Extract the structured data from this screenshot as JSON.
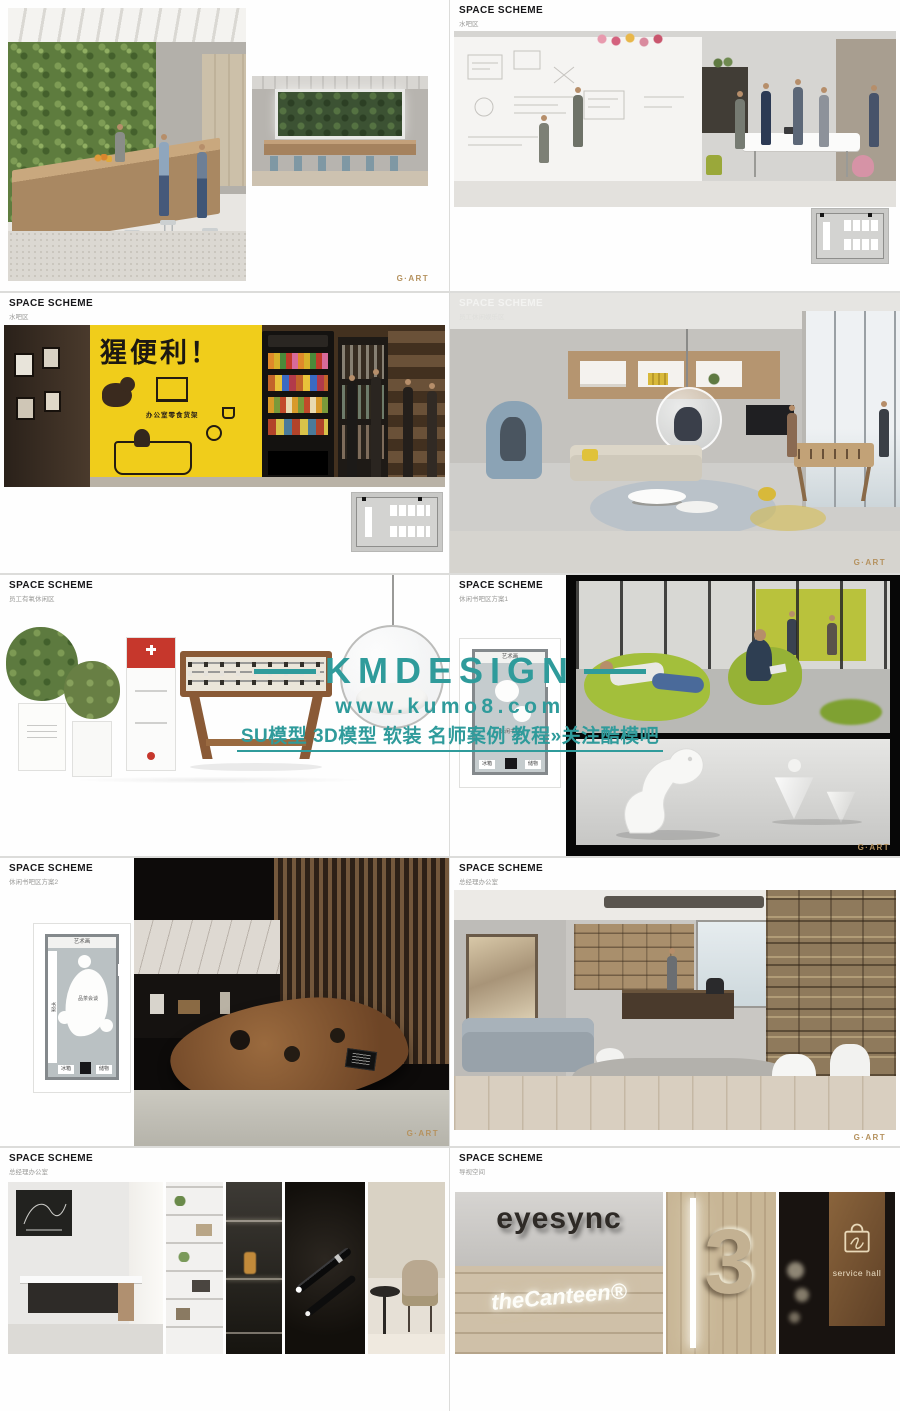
{
  "page": {
    "background": "#dcdcda",
    "slide_background": "#fefefe"
  },
  "brand_logo": {
    "text": "G·ART",
    "color": "#b5925f"
  },
  "watermark": {
    "brand": "KMDESIGN",
    "url": "www.kumo8.com",
    "tagline": "SU模型 3D模型 软装 名师案例 教程»关注酷模吧",
    "color": "#2f9b9b"
  },
  "slides": [
    {
      "title": "",
      "subtitle": ""
    },
    {
      "title": "SPACE SCHEME",
      "subtitle": "水吧区"
    },
    {
      "title": "SPACE SCHEME",
      "subtitle": "水吧区"
    },
    {
      "title": "SPACE SCHEME",
      "subtitle": "员工休闲娱乐区"
    },
    {
      "title": "SPACE SCHEME",
      "subtitle": "员工有氧休闲区"
    },
    {
      "title": "SPACE SCHEME",
      "subtitle": "休闲书吧区方案1"
    },
    {
      "title": "SPACE SCHEME",
      "subtitle": "休闲书吧区方案2"
    },
    {
      "title": "SPACE SCHEME",
      "subtitle": "总经理办公室"
    },
    {
      "title": "SPACE SCHEME",
      "subtitle": "总经理办公室"
    },
    {
      "title": "SPACE SCHEME",
      "subtitle": "导视空间"
    }
  ],
  "store": {
    "sign": "猩便利！",
    "caption": "办公室零食货架"
  },
  "floor_plan_1": {
    "top": "艺术画",
    "center": "休闲书吧",
    "box_left": "冰箱",
    "box_right": "储物"
  },
  "floor_plan_2": {
    "top": "艺术画",
    "left": "书架",
    "center": "品茶会谈",
    "box_left": "冰箱",
    "box_right": "储物"
  },
  "signage": {
    "brand_sign": "eyesync",
    "canteen_sign": "theCanteen®",
    "floor_number": "3",
    "hall_sign": "service hall"
  }
}
